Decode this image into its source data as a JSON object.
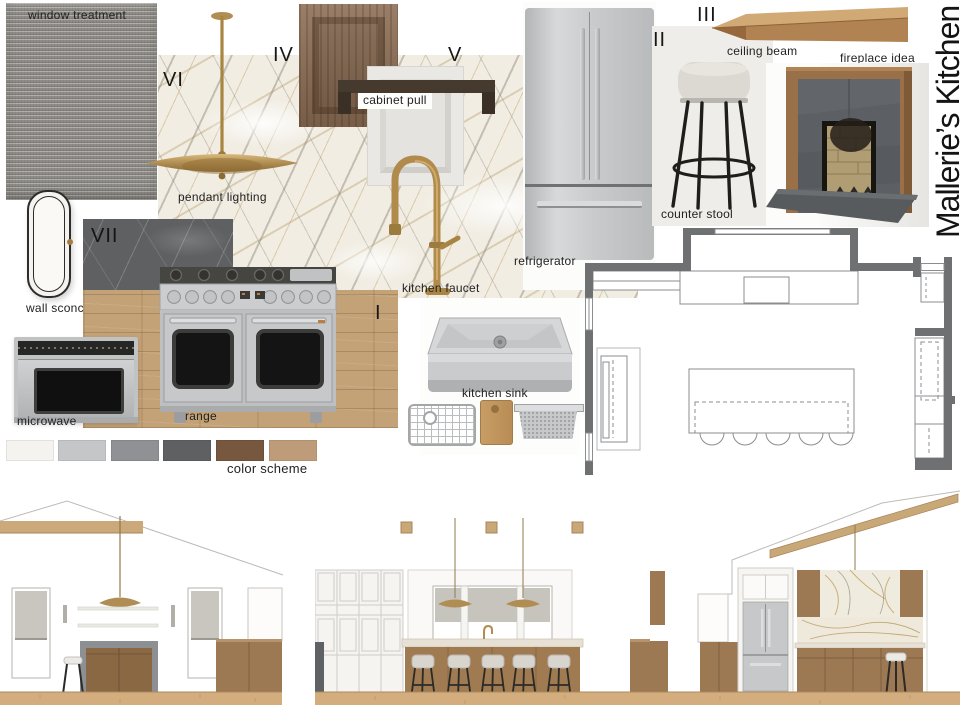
{
  "board": {
    "title": "Mallerie’s Kitchen",
    "labels": {
      "window_treatment": "window treatment",
      "pendant_lighting": "pendant lighting",
      "cabinet_pull": "cabinet pull",
      "refrigerator": "refrigerator",
      "counter_stool": "counter stool",
      "ceiling_beam": "ceiling beam",
      "fireplace_idea": "fireplace idea",
      "wall_sconce": "wall sconce",
      "kitchen_faucet": "kitchen faucet",
      "microwave": "microwave",
      "range": "range",
      "kitchen_sink": "kitchen sink"
    },
    "numerals": {
      "i": "I",
      "ii": "II",
      "iii": "III",
      "iv": "IV",
      "v": "V",
      "vi": "VI",
      "vii": "VII"
    },
    "color_scheme": {
      "label": "color scheme",
      "swatches": [
        "#f4f3ef",
        "#c4c6c7",
        "#8f9194",
        "#5e6062",
        "#77573e",
        "#bf9c79"
      ]
    },
    "accent_colors": {
      "brass": "#b08d52",
      "stainless": "#c6c8ca",
      "plan_wall_gray": "#6e7072",
      "cabinet_wood": "#8b6c53",
      "floor_wood": "#c3a277"
    }
  }
}
